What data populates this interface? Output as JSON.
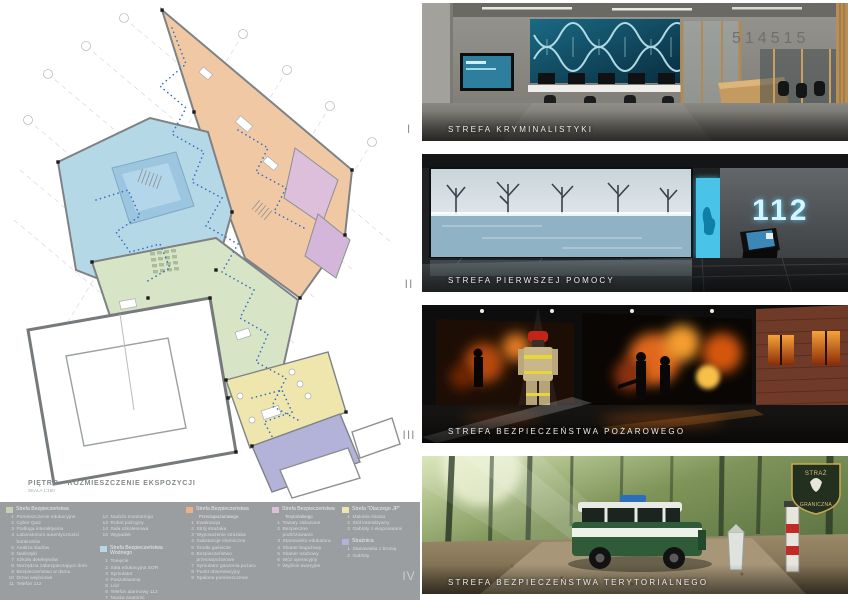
{
  "plan": {
    "title": "PIĘTRO - ROZMIESZCZENIE EKSPOZYCJI",
    "scale": "SKALA 1:150"
  },
  "legend": {
    "panel_color": "#9b9ea1",
    "sections": {
      "safety": {
        "title": "Strefa Bezpieczeństwa",
        "color": "#c6cfb2",
        "items": [
          {
            "no": "1",
            "label": "Pomieszczenie edukacyjne"
          },
          {
            "no": "2",
            "label": "Cyber Quiz"
          },
          {
            "no": "3",
            "label": "Podłoga interaktywna"
          },
          {
            "no": "4",
            "label": "Laboratorium autentyczności banknotów"
          },
          {
            "no": "5",
            "label": "Analiza śladów"
          },
          {
            "no": "6",
            "label": "Narkotyki"
          },
          {
            "no": "7",
            "label": "Szkoła detektywów"
          },
          {
            "no": "8",
            "label": "Narzędzia zabezpieczające dom"
          },
          {
            "no": "9",
            "label": "Bezpieczeństwo w domu"
          },
          {
            "no": "10",
            "label": "Drzwi wejściowe"
          },
          {
            "no": "11",
            "label": "Telefon 112"
          }
        ]
      },
      "safety_cont": {
        "items": [
          {
            "no": "12",
            "label": "Nadzór monitoringu"
          },
          {
            "no": "13",
            "label": "Robot policyjny"
          },
          {
            "no": "14",
            "label": "Sala szkoleniowa"
          },
          {
            "no": "15",
            "label": "Wypadek"
          }
        ]
      },
      "water": {
        "title": "Strefa Bezpieczeństwa Wodnego",
        "color": "#b5d8e6",
        "items": [
          {
            "no": "1",
            "label": "Tonięcie"
          },
          {
            "no": "2",
            "label": "Sala edukacyjna SOR"
          },
          {
            "no": "3",
            "label": "Symulator"
          },
          {
            "no": "4",
            "label": "Poszukiwania"
          },
          {
            "no": "5",
            "label": "Lód"
          },
          {
            "no": "6",
            "label": "Telefon alarmowy 112"
          },
          {
            "no": "7",
            "label": "Nauka anatomii"
          }
        ]
      },
      "fire": {
        "title": "Strefa Bezpieczeństwa",
        "title2": "Przeciwpożarowego",
        "color": "#edb083",
        "items": [
          {
            "no": "1",
            "label": "Ewakuacja"
          },
          {
            "no": "2",
            "label": "Strój strażaka"
          },
          {
            "no": "3",
            "label": "Wyposażenie strażaka"
          },
          {
            "no": "4",
            "label": "Substancje chemiczne"
          },
          {
            "no": "5",
            "label": "Środki gaśnicze"
          },
          {
            "no": "6",
            "label": "Bezpieczeństwo przeciwpożarowe"
          },
          {
            "no": "7",
            "label": "Symulator gaszenia pożaru"
          },
          {
            "no": "8",
            "label": "Punkt obserwacyjny"
          },
          {
            "no": "9",
            "label": "Spalone pomieszczenie"
          }
        ]
      },
      "territorial": {
        "title": "Strefa Bezpieczeństwa",
        "title2": "Terytorialnego",
        "color": "#ddbfdc",
        "items": [
          {
            "no": "1",
            "label": "Towary zakazane"
          },
          {
            "no": "2",
            "label": "Bezpieczne podróżowanie"
          },
          {
            "no": "3",
            "label": "Stanowisko edukatora"
          },
          {
            "no": "4",
            "label": "Skaner bagażowy"
          },
          {
            "no": "5",
            "label": "Skaner osobowy"
          },
          {
            "no": "6",
            "label": "Wóz operacyjny"
          },
          {
            "no": "7",
            "label": "Wyjście awaryjne"
          }
        ]
      },
      "why": {
        "title": "Strefa \"Dlaczego JP\"",
        "color": "#efe6ae",
        "items": [
          {
            "no": "1",
            "label": "Makieta miasta"
          },
          {
            "no": "2",
            "label": "Stół interaktywny"
          },
          {
            "no": "3",
            "label": "Gabloty z eksponatami"
          }
        ]
      },
      "watchtower": {
        "title": "Strażnica",
        "color": "#b3b3d9",
        "items": [
          {
            "no": "1",
            "label": "Stanowiska z bronią"
          },
          {
            "no": "2",
            "label": "Gabloty"
          }
        ]
      }
    }
  },
  "renders": [
    {
      "numeral": "I",
      "caption": "STREFA KRYMINALISTYKI",
      "wall_text": "514515"
    },
    {
      "numeral": "II",
      "caption": "STREFA PIERWSZEJ POMOCY",
      "wall_text": "112"
    },
    {
      "numeral": "III",
      "caption": "STREFA BEZPIECZEŃSTWA POŻAROWEGO"
    },
    {
      "numeral": "IV",
      "caption": "STREFA BEZPIECZEŃSTWA TERYTORIALNEGO",
      "badge_line1": "STRAŻ",
      "badge_line2": "GRANICZNA"
    }
  ]
}
